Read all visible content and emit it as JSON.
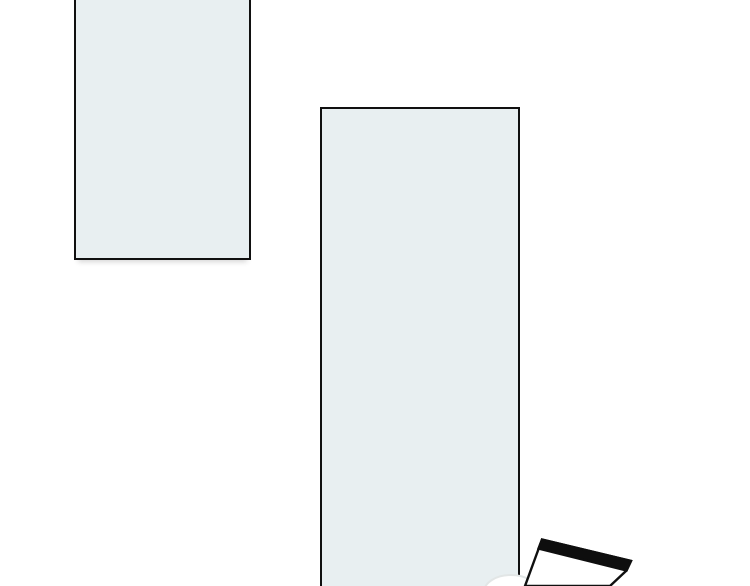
{
  "artwork": {
    "background_color": "#ffffff",
    "panel_fill": "#e8eff1",
    "line_color": "#101010",
    "panels": [
      {
        "name": "top-left-panel",
        "note_fill": "#e8eff1"
      },
      {
        "name": "center-panel",
        "note_fill": "#e8eff1"
      }
    ],
    "falling_card": {
      "outline_points": "542,539.5 631,561 626.5,570.5 610,586 525,586",
      "band_points": "542,539.5 631,561 626.5,570.5 538.5,548.5",
      "fill": "#ffffff",
      "band_fill": "#0e0e0e",
      "stroke_width": "2.4"
    },
    "blob": {
      "cx": "511",
      "cy": "592",
      "rx": "27",
      "ry": "17",
      "fill": "#ffffff",
      "edge_color": "#e2e6e6",
      "edge_width": "2"
    }
  }
}
